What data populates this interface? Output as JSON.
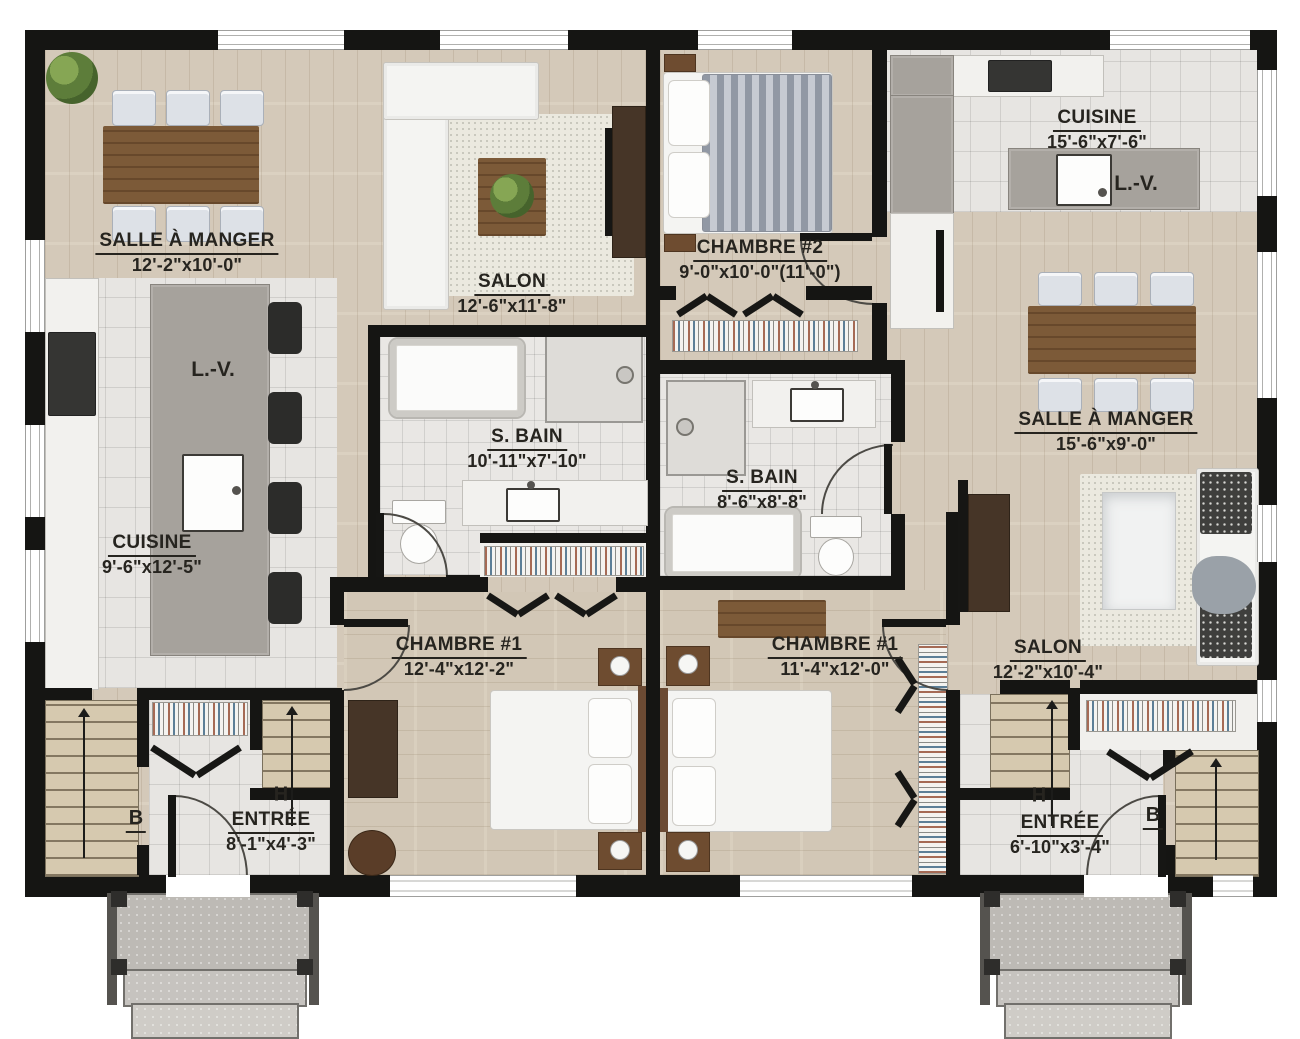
{
  "plan": {
    "type": "duplex-floor-plan",
    "left_unit": {
      "dining": {
        "name": "SALLE À MANGER",
        "dims": "12'-2\"x10'-0\""
      },
      "salon": {
        "name": "SALON",
        "dims": "12'-6\"x11'-8\""
      },
      "cuisine": {
        "name": "CUISINE",
        "dims": "9'-6\"x12'-5\""
      },
      "bath": {
        "name": "S. BAIN",
        "dims": "10'-11\"x7'-10\""
      },
      "chambre1": {
        "name": "CHAMBRE #1",
        "dims": "12'-4\"x12'-2\""
      },
      "entree": {
        "name": "ENTRÉE",
        "dims": "8'-1\"x4'-3\""
      },
      "dishwasher": "L.-V.",
      "stairs_down": "B",
      "stairs_up": "H"
    },
    "right_unit": {
      "chambre2": {
        "name": "CHAMBRE #2",
        "dims": "9'-0\"x10'-0\"(11'-0\")"
      },
      "cuisine": {
        "name": "CUISINE",
        "dims": "15'-6\"x7'-6\""
      },
      "dining": {
        "name": "SALLE À MANGER",
        "dims": "15'-6\"x9'-0\""
      },
      "bath": {
        "name": "S. BAIN",
        "dims": "8'-6\"x8'-8\""
      },
      "chambre1": {
        "name": "CHAMBRE #1",
        "dims": "11'-4\"x12'-0\""
      },
      "salon": {
        "name": "SALON",
        "dims": "12'-2\"x10'-4\""
      },
      "entree": {
        "name": "ENTRÉE",
        "dims": "6'-10\"x3'-4\""
      },
      "dishwasher": "L.-V.",
      "stairs_down": "B",
      "stairs_up": "H"
    },
    "colors": {
      "wall": "#151513",
      "wood_floor": "#d9cebd",
      "tile_floor": "#e7e5e2",
      "counter_gray": "#a6a29c",
      "table_wood": "#7c5a38",
      "label_text": "#26241f"
    }
  }
}
